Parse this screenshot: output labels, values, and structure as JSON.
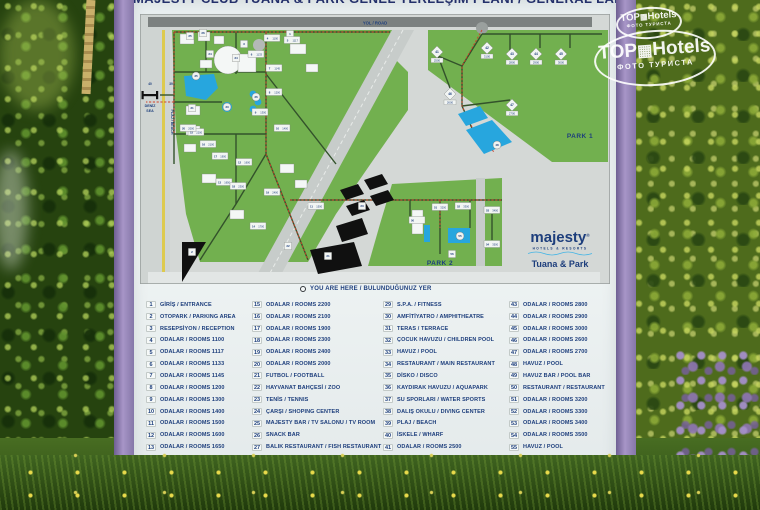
{
  "watermark": {
    "brand_left": "TOP",
    "brand_right": "Hotels",
    "sub": "ФОТО ТУРИСТА"
  },
  "sign": {
    "title": "MAJESTY CLUB TUANA & PARK GENEL YERLEŞİM PLANI / GENERAL LAND PLAN",
    "map": {
      "road_label": "YOL / ROAD",
      "sea_label_line1": "DENİZ",
      "sea_label_line2": "SEA",
      "beach_label": "PLAJ / BEACH",
      "beach_num": "39",
      "wharf_num": "40",
      "park1_label": "PARK 1",
      "park2_label": "PARK 2",
      "logo": {
        "brand": "majesty",
        "reg": "®",
        "tagline": "HOTELS & RESORTS",
        "resort": "Tuana & Park"
      },
      "markers": [
        {
          "n": "1",
          "kind": "plain"
        },
        {
          "n": "2",
          "kind": "plain"
        },
        {
          "n": "3",
          "kind": "plain"
        },
        {
          "n": "4",
          "kind": "room",
          "room": "1100"
        },
        {
          "n": "5",
          "kind": "room",
          "room": "1117"
        },
        {
          "n": "6",
          "kind": "room",
          "room": "1133"
        },
        {
          "n": "7",
          "kind": "room",
          "room": "1145"
        },
        {
          "n": "8",
          "kind": "room",
          "room": "1200"
        },
        {
          "n": "9",
          "kind": "room",
          "room": "1300"
        },
        {
          "n": "10",
          "kind": "room",
          "room": "1400"
        },
        {
          "n": "11",
          "kind": "room",
          "room": "1500"
        },
        {
          "n": "12",
          "kind": "room",
          "room": "1600"
        },
        {
          "n": "13",
          "kind": "room",
          "room": "1650"
        },
        {
          "n": "14",
          "kind": "room",
          "room": "1700"
        },
        {
          "n": "15",
          "kind": "room",
          "room": "2200"
        },
        {
          "n": "16",
          "kind": "room",
          "room": "2100"
        },
        {
          "n": "17",
          "kind": "room",
          "room": "1900"
        },
        {
          "n": "18",
          "kind": "room",
          "room": "2300"
        },
        {
          "n": "19",
          "kind": "room",
          "room": "2400"
        },
        {
          "n": "20",
          "kind": "room",
          "room": "2000"
        },
        {
          "n": "21",
          "kind": "plain"
        },
        {
          "n": "22",
          "kind": "plain"
        },
        {
          "n": "23",
          "kind": "plain"
        },
        {
          "n": "24",
          "kind": "plain"
        },
        {
          "n": "25",
          "kind": "plain"
        },
        {
          "n": "26",
          "kind": "plain"
        },
        {
          "n": "31",
          "kind": "plain"
        },
        {
          "n": "34",
          "kind": "plain"
        },
        {
          "n": "33",
          "kind": "pool"
        },
        {
          "n": "35",
          "kind": "pool"
        },
        {
          "n": "36",
          "kind": "pool"
        },
        {
          "n": "41",
          "kind": "diamond",
          "room": "2500"
        },
        {
          "n": "42",
          "kind": "diamond",
          "room": "3100"
        },
        {
          "n": "43",
          "kind": "diamond",
          "room": "2800"
        },
        {
          "n": "44",
          "kind": "diamond",
          "room": "2900"
        },
        {
          "n": "45",
          "kind": "diamond",
          "room": "3000"
        },
        {
          "n": "46",
          "kind": "diamond",
          "room": "2600"
        },
        {
          "n": "47",
          "kind": "diamond",
          "room": "2700"
        },
        {
          "n": "48",
          "kind": "pool"
        },
        {
          "n": "50",
          "kind": "room",
          "room": ""
        },
        {
          "n": "51",
          "kind": "room",
          "room": "3200"
        },
        {
          "n": "52",
          "kind": "room",
          "room": "3300"
        },
        {
          "n": "53",
          "kind": "room",
          "room": "3400"
        },
        {
          "n": "54",
          "kind": "room",
          "room": "3500"
        },
        {
          "n": "55",
          "kind": "pool"
        },
        {
          "n": "56",
          "kind": "plain"
        }
      ]
    },
    "you_are_here": "YOU ARE HERE / BULUNDUĞUNUZ YER",
    "legend": {
      "items": [
        {
          "n": 1,
          "label": "GİRİŞ / ENTRANCE"
        },
        {
          "n": 2,
          "label": "OTOPARK / PARKING AREA"
        },
        {
          "n": 3,
          "label": "RESEPSİYON / RECEPTION"
        },
        {
          "n": 4,
          "label": "ODALAR / ROOMS 1100"
        },
        {
          "n": 5,
          "label": "ODALAR / ROOMS 1117"
        },
        {
          "n": 6,
          "label": "ODALAR / ROOMS 1133"
        },
        {
          "n": 7,
          "label": "ODALAR / ROOMS 1145"
        },
        {
          "n": 8,
          "label": "ODALAR / ROOMS 1200"
        },
        {
          "n": 9,
          "label": "ODALAR / ROOMS 1300"
        },
        {
          "n": 10,
          "label": "ODALAR / ROOMS 1400"
        },
        {
          "n": 11,
          "label": "ODALAR / ROOMS 1500"
        },
        {
          "n": 12,
          "label": "ODALAR / ROOMS 1600"
        },
        {
          "n": 13,
          "label": "ODALAR / ROOMS 1650"
        },
        {
          "n": 14,
          "label": "ODALAR / ROOMS 1700"
        },
        {
          "n": 15,
          "label": "ODALAR / ROOMS 2200"
        },
        {
          "n": 16,
          "label": "ODALAR / ROOMS 2100"
        },
        {
          "n": 17,
          "label": "ODALAR / ROOMS 1900"
        },
        {
          "n": 18,
          "label": "ODALAR / ROOMS 2300"
        },
        {
          "n": 19,
          "label": "ODALAR / ROOMS 2400"
        },
        {
          "n": 20,
          "label": "ODALAR / ROOMS 2000"
        },
        {
          "n": 21,
          "label": "FUTBOL / FOOTBALL"
        },
        {
          "n": 22,
          "label": "HAYVANAT BAHÇESİ / ZOO"
        },
        {
          "n": 23,
          "label": "TENİS / TENNIS"
        },
        {
          "n": 24,
          "label": "ÇARŞI / SHOPING CENTER"
        },
        {
          "n": 25,
          "label": "MAJESTY BAR / TV SALONU / TV ROOM"
        },
        {
          "n": 26,
          "label": "SNACK BAR"
        },
        {
          "n": 27,
          "label": "BALIK RESTAURANT / FISH RESTAURANT"
        },
        {
          "n": 28,
          "label": "DOKTOR / DOCTOR"
        },
        {
          "n": 29,
          "label": "S.P.A. / FITNESS"
        },
        {
          "n": 30,
          "label": "AMFİTİYATRO / AMPHITHEATRE"
        },
        {
          "n": 31,
          "label": "TERAS / TERRACE"
        },
        {
          "n": 32,
          "label": "ÇOCUK HAVUZU / CHILDREN POOL"
        },
        {
          "n": 33,
          "label": "HAVUZ / POOL"
        },
        {
          "n": 34,
          "label": "RESTAURANT / MAIN RESTAURANT"
        },
        {
          "n": 35,
          "label": "DİSKO / DISCO"
        },
        {
          "n": 36,
          "label": "KAYDIRAK HAVUZU / AQUAPARK"
        },
        {
          "n": 37,
          "label": "SU SPORLARI / WATER SPORTS"
        },
        {
          "n": 38,
          "label": "DALIŞ OKULU / DIVING CENTER"
        },
        {
          "n": 39,
          "label": "PLAJ / BEACH"
        },
        {
          "n": 40,
          "label": "İSKELE / WHARF"
        },
        {
          "n": 41,
          "label": "ODALAR / ROOMS 2500"
        },
        {
          "n": 42,
          "label": "ODALAR / ROOMS 3100"
        },
        {
          "n": 43,
          "label": "ODALAR / ROOMS 2800"
        },
        {
          "n": 44,
          "label": "ODALAR / ROOMS 2900"
        },
        {
          "n": 45,
          "label": "ODALAR / ROOMS 3000"
        },
        {
          "n": 46,
          "label": "ODALAR / ROOMS 2600"
        },
        {
          "n": 47,
          "label": "ODALAR / ROOMS 2700"
        },
        {
          "n": 48,
          "label": "HAVUZ / POOL"
        },
        {
          "n": 49,
          "label": "HAVUZ BAR / POOL BAR"
        },
        {
          "n": 50,
          "label": "RESTAURANT / RESTAURANT"
        },
        {
          "n": 51,
          "label": "ODALAR / ROOMS 3200"
        },
        {
          "n": 52,
          "label": "ODALAR / ROOMS 3300"
        },
        {
          "n": 53,
          "label": "ODALAR / ROOMS 3400"
        },
        {
          "n": 54,
          "label": "ODALAR / ROOMS 3500"
        },
        {
          "n": 55,
          "label": "HAVUZ / POOL"
        },
        {
          "n": 56,
          "label": "HAVUZ BAR / POOL BAR"
        }
      ]
    }
  }
}
